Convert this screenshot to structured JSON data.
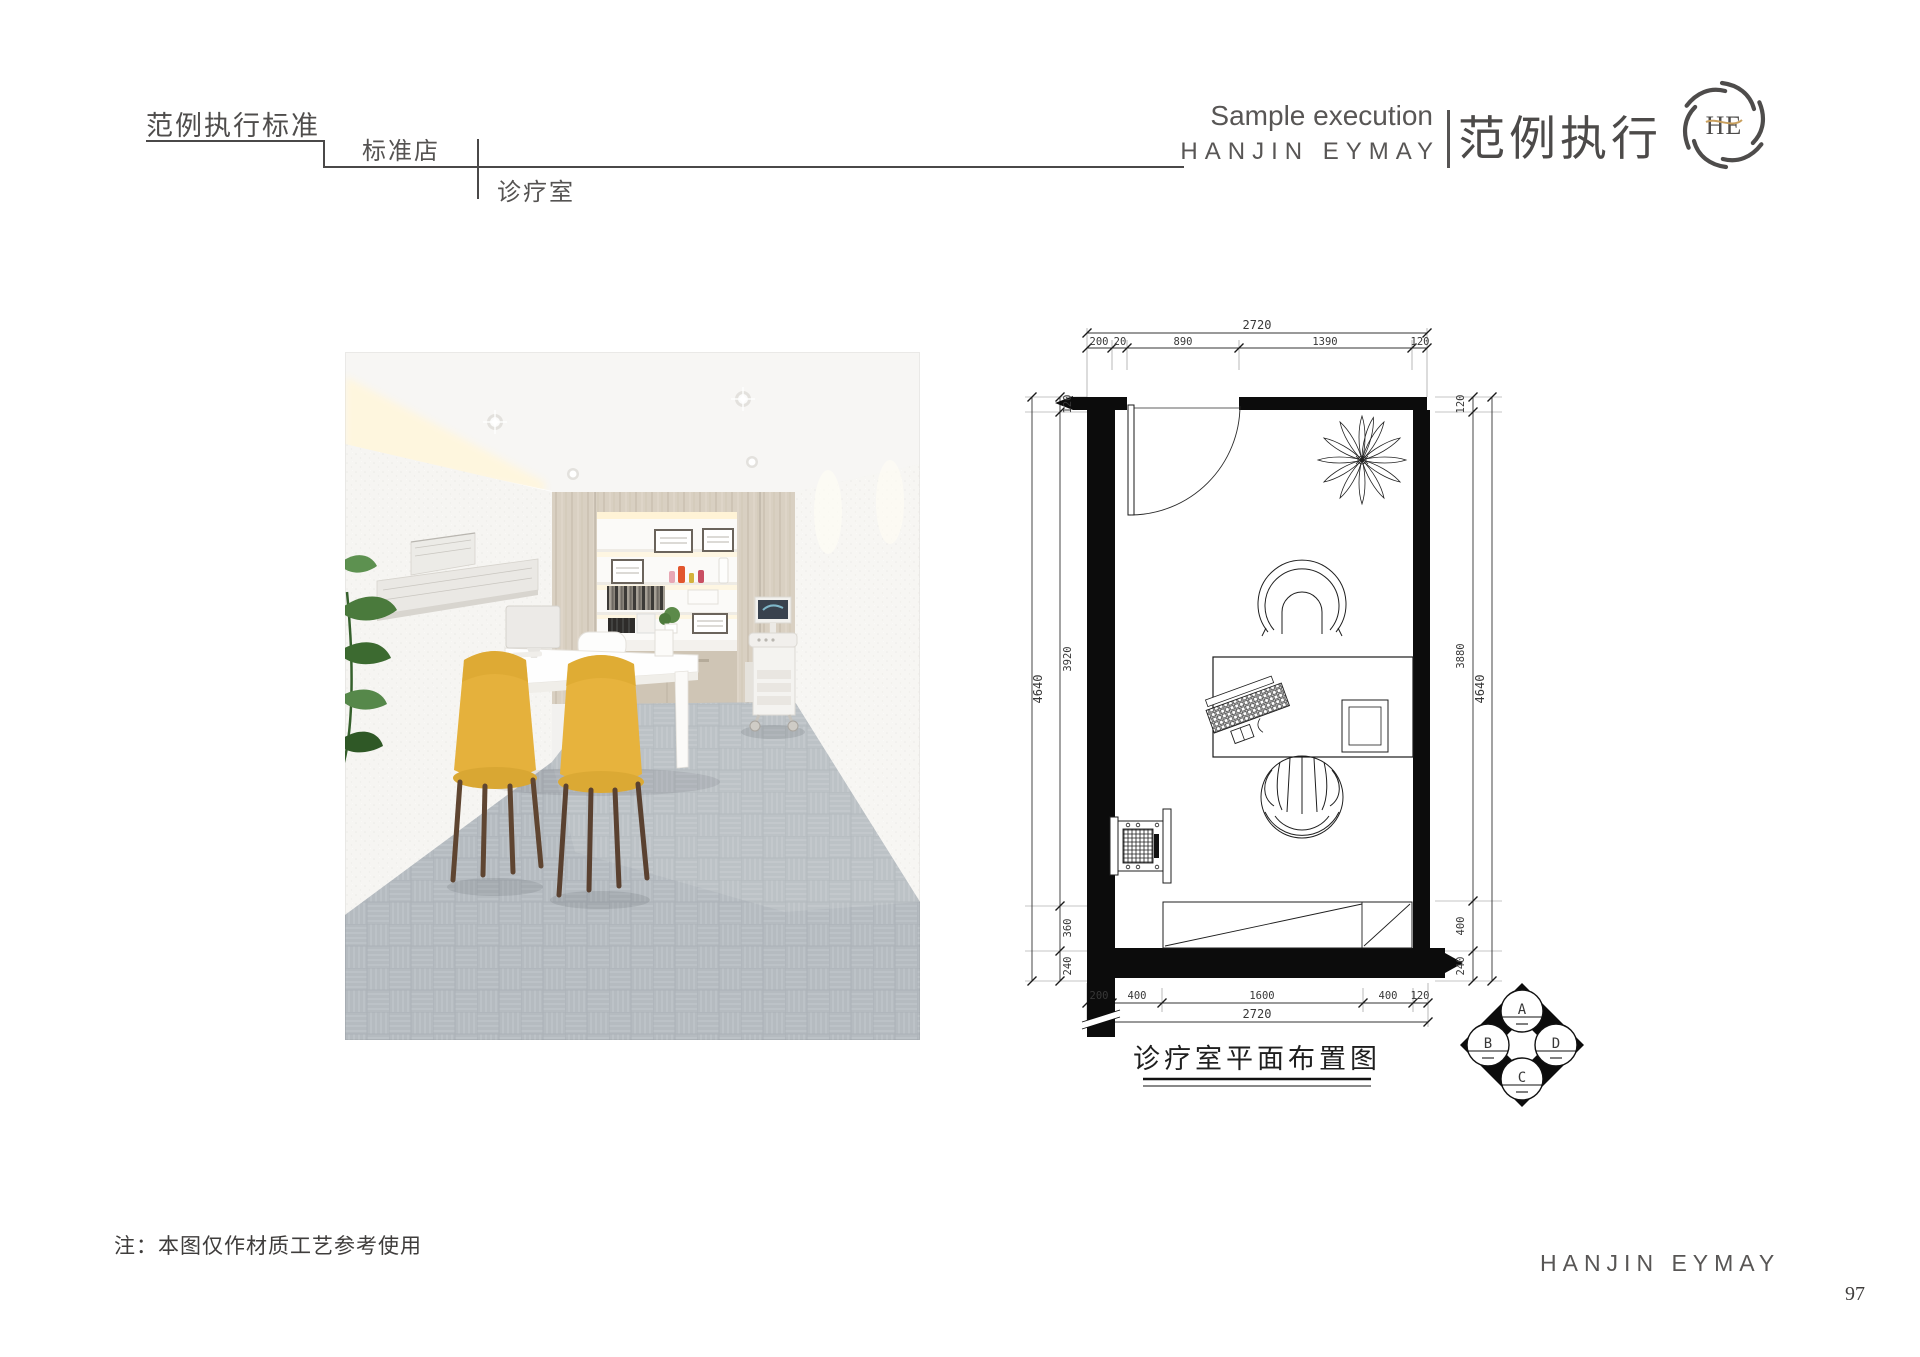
{
  "header": {
    "title": "范例执行标准",
    "store_level": "标准店",
    "room_level": "诊疗室",
    "subtitle_en": "Sample execution",
    "brand_en": "HANJIN EYMAY",
    "slogan_cn": "范例执行",
    "logo_monogram": "HE"
  },
  "plan": {
    "caption": "诊疗室平面布置图",
    "dims": {
      "top_total": "2720",
      "top": [
        "200",
        "20",
        "890",
        "1390",
        "120"
      ],
      "left_outer": "4640",
      "left": [
        "120",
        "3920",
        "360",
        "240"
      ],
      "right": [
        "120",
        "3880",
        "400",
        "240"
      ],
      "right_outer": "4640",
      "bottom": [
        "200",
        "400",
        "1600",
        "400",
        "120"
      ],
      "bottom_total": "2720"
    },
    "marker": {
      "a": "A",
      "b": "B",
      "c": "C",
      "d": "D"
    }
  },
  "footer": {
    "note": "注：本图仅作材质工艺参考使用",
    "brand_en": "HANJIN EYMAY",
    "page_number": "97"
  }
}
